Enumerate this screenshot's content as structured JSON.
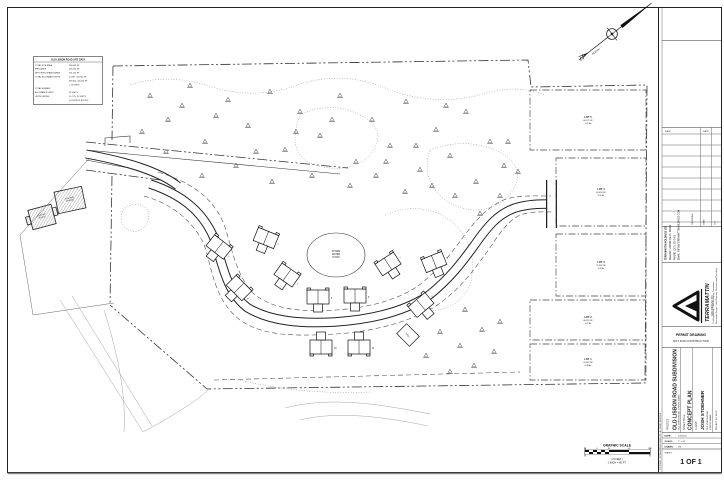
{
  "site_table": {
    "title": "OLD LISBON ROAD SITE DATA",
    "rows": [
      [
        "TOTAL SITE AREA",
        "968,024 SF"
      ],
      [
        "WETLANDS",
        "206,474 SF"
      ],
      [
        "NET DEVELOPABLE AREA",
        "761,550 SF"
      ],
      [
        "TOTAL ALLOWABLE UNITS",
        "1 UNIT / 40,000 SF"
      ],
      [
        "",
        "968,024 / 40,000 SF"
      ],
      [
        "",
        "= 24 UNITS"
      ],
      [
        "TOTAL NUMBER",
        ""
      ],
      [
        "ALLOWABLE UNITS",
        "24 UNITS"
      ],
      [
        "UNITS SHOWN",
        "5 LOTS, 22 UNITS"
      ],
      [
        "",
        "(11 DUPLEX BLDGS)"
      ]
    ]
  },
  "north_label": "NORTH",
  "scale_bar": {
    "title": "GRAPHIC SCALE",
    "ticks": [
      "30",
      "0",
      "30",
      "60",
      "120"
    ],
    "units": "( IN FEET )",
    "ratio": "1 INCH = 60 FT."
  },
  "plan": {
    "pond_label": [
      "STORM",
      "WATER",
      "POND"
    ],
    "existing_house_label": [
      "EXISTING",
      "HOUSE"
    ],
    "existing_garage_label": [
      "EXISTING",
      "GARAGE"
    ],
    "shed_label": "WELL",
    "lots": [
      {
        "name": "LOT 5",
        "sf": "66,271 SF",
        "ac": "1.52 Ac",
        "x": 530,
        "y": 90,
        "w": 116,
        "h": 60
      },
      {
        "name": "LOT 4",
        "sf": "61,420 SF",
        "ac": "1.41 Ac",
        "x": 556,
        "y": 158,
        "w": 90,
        "h": 68
      },
      {
        "name": "LOT 3",
        "sf": "55,847 SF",
        "ac": "1.28 Ac",
        "x": 556,
        "y": 234,
        "w": 90,
        "h": 62
      },
      {
        "name": "LOT 2",
        "sf": "46,512 SF",
        "ac": "1.07 Ac",
        "x": 530,
        "y": 300,
        "w": 116,
        "h": 40
      },
      {
        "name": "LOT 1",
        "sf": "41,867 SF",
        "ac": "0.96 Ac",
        "x": 530,
        "y": 344,
        "w": 116,
        "h": 36
      }
    ],
    "houses": [
      {
        "n": "1",
        "x": 219,
        "y": 247,
        "r": 38,
        "f": 0
      },
      {
        "n": "2",
        "x": 266,
        "y": 238,
        "r": 22,
        "f": 0
      },
      {
        "n": "3",
        "x": 287,
        "y": 275,
        "r": 35,
        "f": 0
      },
      {
        "n": "4",
        "x": 239,
        "y": 288,
        "r": 45,
        "f": 0
      },
      {
        "n": "5",
        "x": 318,
        "y": 297,
        "r": 0,
        "f": 0
      },
      {
        "n": "6",
        "x": 355,
        "y": 296,
        "r": 0,
        "f": 0
      },
      {
        "n": "7",
        "x": 388,
        "y": 264,
        "r": -33,
        "f": 0
      },
      {
        "n": "8",
        "x": 434,
        "y": 262,
        "r": -22,
        "f": 0
      },
      {
        "n": "9",
        "x": 421,
        "y": 305,
        "r": -40,
        "f": 0
      },
      {
        "n": "10",
        "x": 321,
        "y": 347,
        "r": 0,
        "f": 1
      },
      {
        "n": "11",
        "x": 359,
        "y": 347,
        "r": 0,
        "f": 1
      }
    ],
    "trees": [
      [
        150,
        96
      ],
      [
        168,
        120
      ],
      [
        190,
        86
      ],
      [
        205,
        142
      ],
      [
        228,
        100
      ],
      [
        248,
        126
      ],
      [
        270,
        92
      ],
      [
        285,
        150
      ],
      [
        300,
        112
      ],
      [
        320,
        136
      ],
      [
        340,
        96
      ],
      [
        356,
        162
      ],
      [
        372,
        120
      ],
      [
        390,
        146
      ],
      [
        406,
        102
      ],
      [
        420,
        170
      ],
      [
        436,
        130
      ],
      [
        450,
        156
      ],
      [
        466,
        112
      ],
      [
        476,
        182
      ],
      [
        490,
        142
      ],
      [
        504,
        166
      ],
      [
        350,
        186
      ],
      [
        312,
        176
      ],
      [
        272,
        182
      ],
      [
        236,
        166
      ],
      [
        202,
        176
      ],
      [
        166,
        152
      ],
      [
        142,
        132
      ],
      [
        455,
        196
      ],
      [
        480,
        214
      ],
      [
        500,
        196
      ],
      [
        432,
        186
      ],
      [
        405,
        192
      ],
      [
        376,
        176
      ],
      [
        465,
        310
      ],
      [
        482,
        330
      ],
      [
        494,
        352
      ],
      [
        460,
        346
      ],
      [
        440,
        332
      ],
      [
        426,
        356
      ],
      [
        474,
        366
      ],
      [
        450,
        372
      ],
      [
        500,
        322
      ],
      [
        332,
        120
      ],
      [
        256,
        152
      ],
      [
        216,
        116
      ],
      [
        182,
        106
      ],
      [
        296,
        132
      ],
      [
        386,
        162
      ],
      [
        416,
        146
      ],
      [
        446,
        106
      ],
      [
        508,
        142
      ],
      [
        518,
        172
      ]
    ]
  },
  "title_block": {
    "project_label": "PROJECT:",
    "project_name": "OLD LISBON ROAD SUBDIVISION",
    "project_address": "OLD LISBON ROAD, LISBON, MAINE",
    "sheet_title_label": "SHEET TITLE:",
    "sheet_title": "CONCEPT PLAN",
    "client_label": "CLIENT:",
    "client_name": "JOSH STOEHNER",
    "client_lines": [
      "OLD LISBON ROAD",
      "LISBON, MAINE"
    ],
    "project_no": "PROJECT NO. 24105",
    "permit": [
      "PERMIT DRAWING",
      "NOT FOR CONSTRUCTION"
    ],
    "firm": {
      "name": "TERRAMATTIN",
      "suffix": "HOLDINGS LTD",
      "services": [
        "Civil Engineering - Land Surveying - Excavation",
        "Stormwater Design - Land Planning - Environmental Permitting"
      ],
      "contact": [
        "TERRAMATTIN HOLDINGS LTD",
        "MAILING: LISBON FALLS, MAINE",
        "PHONE: (207) 353-0000",
        "EMAIL: INFO@TERRAMATTINHOLDINGS.COM"
      ]
    },
    "date_headers": [
      "DATE",
      "DATE"
    ],
    "rev_headers": [
      "REVISIONS",
      "DATE",
      "NO."
    ],
    "meta_rows": [
      [
        "DATE:",
        "10/15/24"
      ],
      [
        "SCALE:",
        "1\" = 60'"
      ],
      [
        "DRAWN:",
        "TM"
      ]
    ],
    "sheet_label": "SHEET:",
    "sheet_number": "1 OF 1",
    "copyright": "COPYRIGHT - TERRAMATTIN HOLDINGS LTD - ALL RIGHTS RESERVED"
  }
}
